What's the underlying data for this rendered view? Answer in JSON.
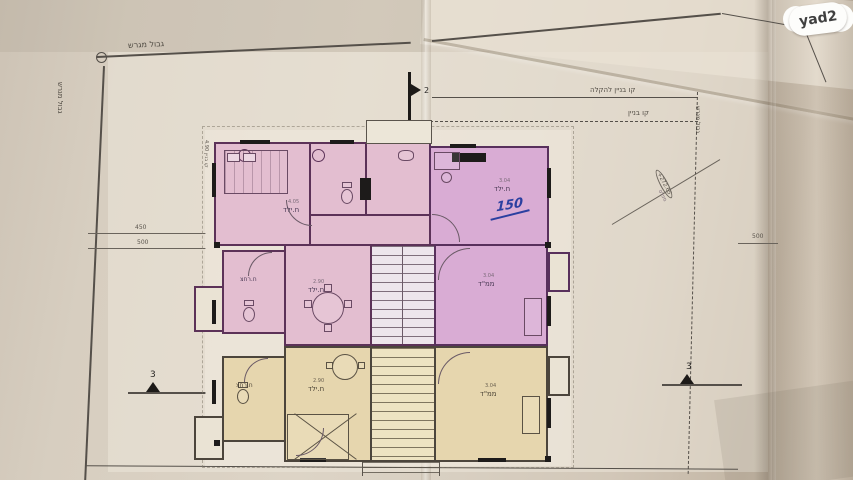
{
  "brand": {
    "watermark": "yad2"
  },
  "site": {
    "boundary_top": "גבול מגרש",
    "boundary_left": "גבול מגרש",
    "boundary_right": "גבול מגרש",
    "building_line_relief": "קו בניין להקלה",
    "building_line": "קו בניין",
    "left_edge_note": "קו בניין 4.90"
  },
  "dims": {
    "left_upper": "450",
    "left_lower": "500",
    "right": "500"
  },
  "sections": {
    "left": "3",
    "right": "3",
    "top": "2"
  },
  "rooms": [
    {
      "label": "ח.ילד",
      "dim": "4.05"
    },
    {
      "label": "ח.ילד",
      "dim": "3.04"
    },
    {
      "label": "ח.רחצ"
    },
    {
      "label": "ח.ילד",
      "dim": "2.90"
    },
    {
      "label": "ממ\"ד",
      "dim": "3.04"
    },
    {
      "label": "ח.רחצ"
    },
    {
      "label": "ח.ילד",
      "dim": "2.90"
    },
    {
      "label": "ממ\"ד",
      "dim": "3.04"
    }
  ],
  "annotations": {
    "handwritten": "150",
    "elevation_line1": "+272.65",
    "elevation_line2": "מפלס"
  }
}
